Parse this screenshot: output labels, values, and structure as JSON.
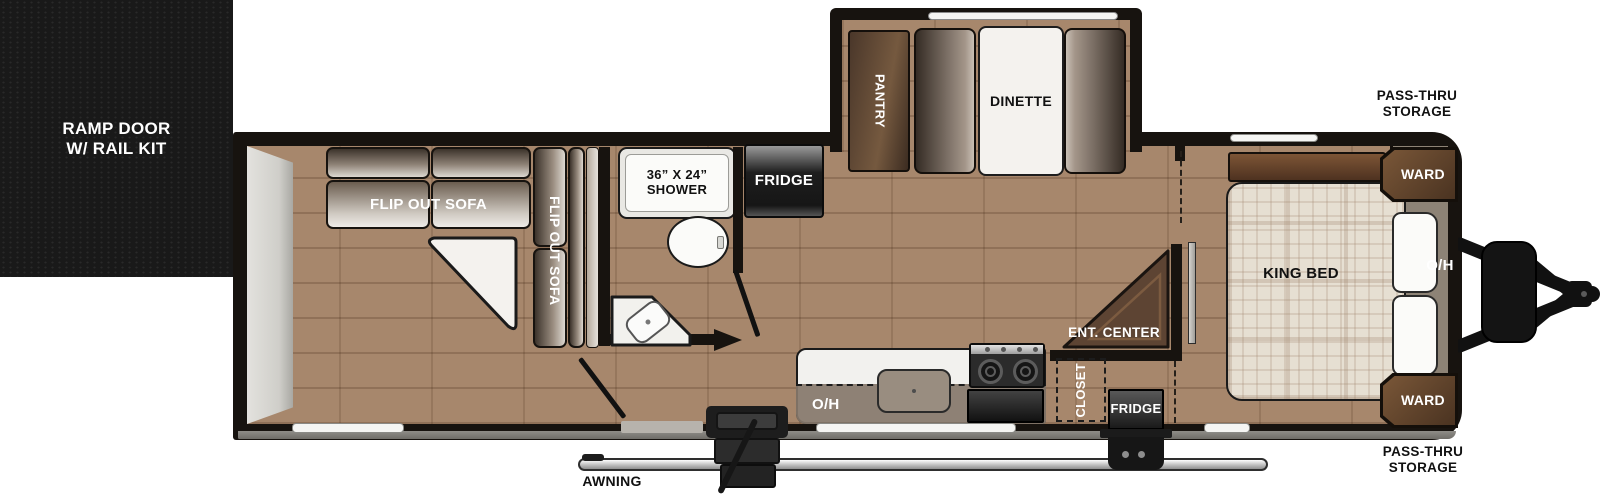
{
  "title": "Travel trailer floor plan",
  "floorplan": {
    "exterior": {
      "ramp_door": "RAMP DOOR\nW/ RAIL KIT",
      "awning": "AWNING",
      "pass_thru_storage_top": "PASS-THRU\nSTORAGE",
      "pass_thru_storage_bottom": "PASS-THRU\nSTORAGE"
    },
    "garage": {
      "flip_out_sofa_rear": "FLIP OUT SOFA",
      "flip_out_sofa_side": "FLIP OUT SOFA"
    },
    "bathroom": {
      "shower": "36” X 24”\nSHOWER"
    },
    "kitchen": {
      "fridge": "FRIDGE",
      "overhead": "O/H"
    },
    "dinette_slideout": {
      "pantry": "PANTRY",
      "dinette": "DINETTE"
    },
    "hallway": {
      "ent_center": "ENT. CENTER",
      "closet": "CLOSET",
      "fridge": "FRIDGE"
    },
    "bedroom": {
      "king_bed": "KING BED",
      "overhead": "O/H",
      "ward_top": "WARD",
      "ward_bottom": "WARD"
    },
    "colors": {
      "wall": "#17130f",
      "floor": "#a7876c",
      "cabinet_brown": "#5d4433",
      "counter_white": "#f2f1ee",
      "overhead_taupe": "#8d8376",
      "appliance_dark": "#1c1c1c",
      "background": "#ffffff"
    }
  }
}
